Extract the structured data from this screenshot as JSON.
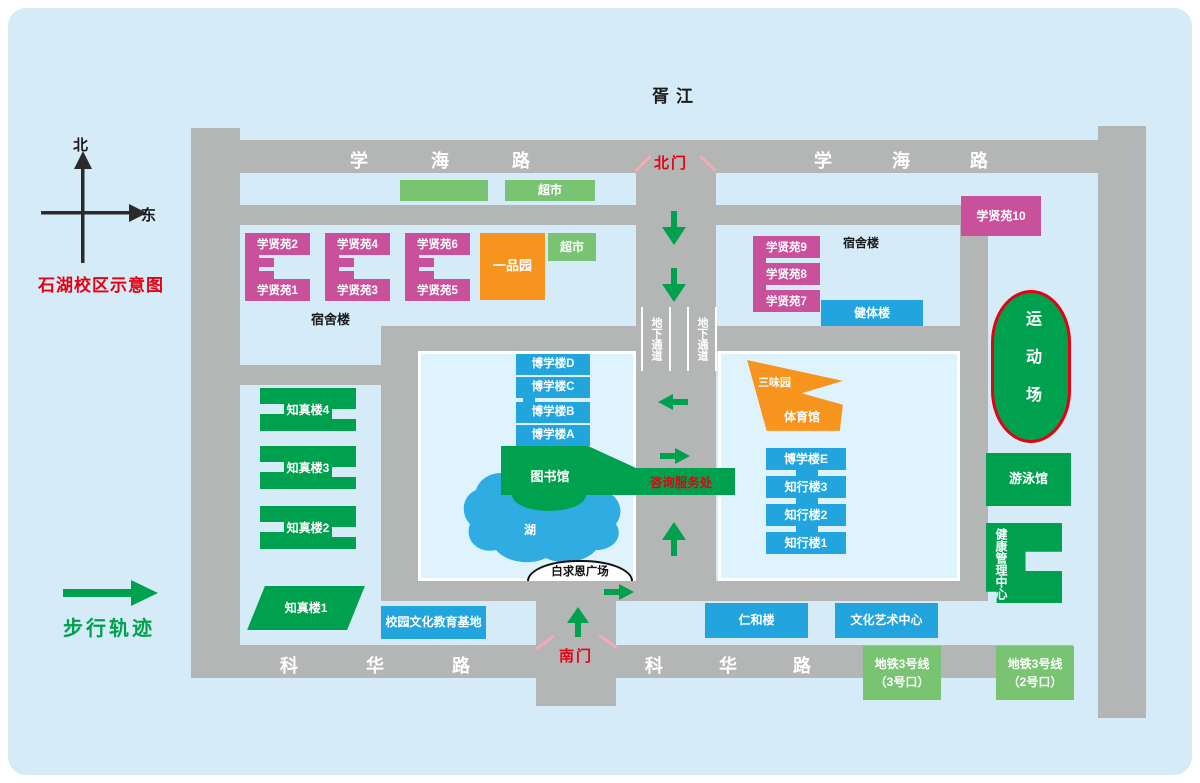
{
  "colors": {
    "road": "#b4b5b5",
    "background": "#d5ebf7",
    "courtyard": "#dff3fd",
    "dorm_magenta": "#c9519b",
    "canteen_orange": "#f7941e",
    "building_green": "#00a14e",
    "market_green": "#79c472",
    "building_blue": "#22a5df",
    "lake_blue": "#2fade3",
    "gate_red": "#e60012",
    "stadium_border": "#e60012",
    "walk_arrow": "#00a14e"
  },
  "header": {
    "river": "胥江",
    "map_title": "石湖校区示意图"
  },
  "compass": {
    "north": "北",
    "east": "东"
  },
  "legend": {
    "walk": "步行轨迹"
  },
  "roads": {
    "xuehai_l": "学海路",
    "xuehai_r": "学海路",
    "kehua_l": "科华路",
    "kehua_r": "科华路",
    "north_gate": "北门",
    "south_gate": "南门",
    "underpass_l": "地下通道",
    "underpass_r": "地下通道"
  },
  "labels": {
    "dorm_l": "宿舍楼",
    "dorm_r": "宿舍楼",
    "plaza": "白求恩广场",
    "lake": "湖",
    "library": "图书馆",
    "info": "咨询服务处"
  },
  "buildings": {
    "market_top": "超市",
    "market_mid": "超市",
    "yipinyuan": "一品园",
    "xxy1": "学贤苑1",
    "xxy2": "学贤苑2",
    "xxy3": "学贤苑3",
    "xxy4": "学贤苑4",
    "xxy5": "学贤苑5",
    "xxy6": "学贤苑6",
    "xxy7": "学贤苑7",
    "xxy8": "学贤苑8",
    "xxy9": "学贤苑9",
    "xxy10": "学贤苑10",
    "jianti": "健体楼",
    "sport": "运动场",
    "swim": "游泳馆",
    "health": "健康管理中心",
    "bxA": "博学楼A",
    "bxB": "博学楼B",
    "bxC": "博学楼C",
    "bxD": "博学楼D",
    "bxE": "博学楼E",
    "zx1": "知行楼1",
    "zx2": "知行楼2",
    "zx3": "知行楼3",
    "zz1": "知真楼1",
    "zz2": "知真楼2",
    "zz3": "知真楼3",
    "zz4": "知真楼4",
    "sanwei": "三味园",
    "gym": "体育馆",
    "renhe": "仁和楼",
    "art": "文化艺术中心",
    "eduBase": "校园文化教育基地",
    "metro3_line": "地铁3号线",
    "metro3_exit": "（3号口）",
    "metro2_line": "地铁3号线",
    "metro2_exit": "（2号口）"
  }
}
